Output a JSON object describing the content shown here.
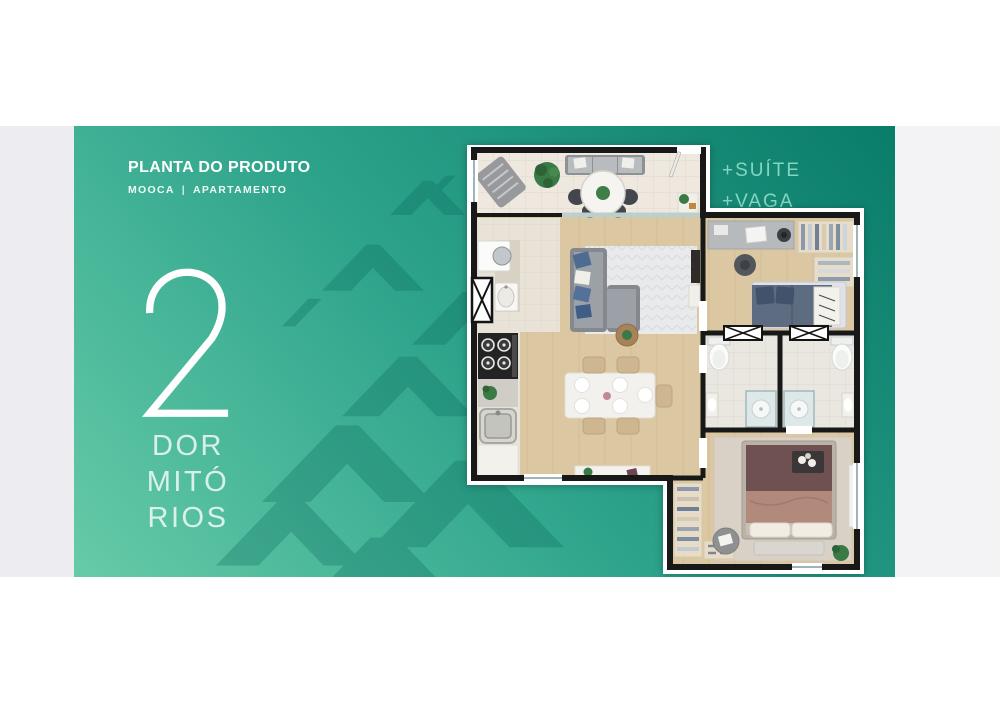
{
  "card": {
    "title": "PLANTA DO PRODUTO",
    "subtitle": {
      "location": "MOOCA",
      "divider": "|",
      "type": "APARTAMENTO"
    },
    "bedrooms": {
      "number": "2",
      "label_lines": [
        "DOR",
        "MITÓ",
        "RIOS"
      ]
    },
    "features": [
      "+SUÍTE",
      "+VAGA"
    ],
    "colors": {
      "gradient_light": "#66cba8",
      "gradient_mid": "#2da38b",
      "gradient_dark": "#0a7c6a",
      "chevron_pattern": "#056557",
      "feature_text": "#84d6c0",
      "title_text": "#ffffff"
    }
  },
  "layout_bands": {
    "left_band_color": "#ececf1",
    "right_band_color": "#f3f3f6",
    "page_background": "#ffffff"
  },
  "floor_plan": {
    "backing_color": "#ffffff",
    "wall_color": "#181818",
    "floor_colors": {
      "wood": "#dcc7a3",
      "balcony_tile": "#eee8de",
      "service_tile": "#e9e2d6",
      "bath_tile": "#eae6e0",
      "living_rug": "#e9eaec",
      "suite_rug": "#d9d1c5"
    },
    "furniture": [
      "lounge-chair",
      "balcony-plant",
      "balcony-sofa",
      "round-table",
      "balcony-chairs",
      "entry-door",
      "entry-shelf",
      "washer",
      "laundry-sink",
      "stove",
      "kitchen-counter",
      "kitchen-sink",
      "kitchen-cabinet",
      "living-rug",
      "living-sofa",
      "coffee-table",
      "tv-panel",
      "dining-table",
      "dining-chairs",
      "sideboard",
      "desk",
      "desk-chair",
      "wardrobe",
      "single-bed",
      "toilet",
      "shower",
      "bath-sink",
      "suite-wardrobe",
      "double-bed",
      "bed-bench",
      "pouf",
      "suite-plant",
      "mirror"
    ]
  }
}
